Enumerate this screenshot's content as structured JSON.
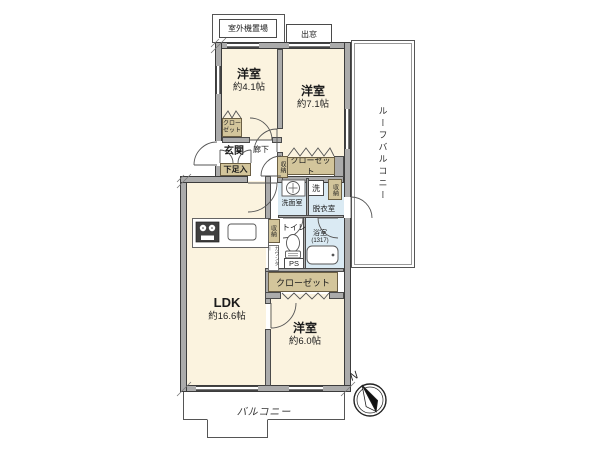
{
  "colors": {
    "room_fill": "#FBF3DF",
    "wet_room_fill": "#DAEAF3",
    "closet_fill": "#D3C59B",
    "wall_fill": "#ABABAB",
    "line": "#444444"
  },
  "plan": {
    "rooms": {
      "western_a": {
        "name": "洋室",
        "size": "約4.1帖"
      },
      "western_b": {
        "name": "洋室",
        "size": "約7.1帖"
      },
      "western_c": {
        "name": "洋室",
        "size": "約6.0帖"
      },
      "ldk": {
        "name": "LDK",
        "size": "約16.6帖"
      },
      "entrance": "玄関",
      "hallway": "廊下",
      "shoe_cabinet": "下足入",
      "washroom": "洗面室",
      "dressing_room": "脱衣室",
      "toilet": "トイレ",
      "bathroom": {
        "name": "浴室",
        "size": "(1317)"
      },
      "washer": "洗",
      "pipe_space": "PS",
      "closet": "クローゼット",
      "storage": "収納",
      "counter": "カウンター"
    },
    "exterior": {
      "balcony": "バルコニー",
      "roof_balcony": "ルーフバルコニー",
      "outdoor_unit": "室外機置場",
      "bay_window": "出窓"
    },
    "compass": {
      "north": "N"
    }
  }
}
